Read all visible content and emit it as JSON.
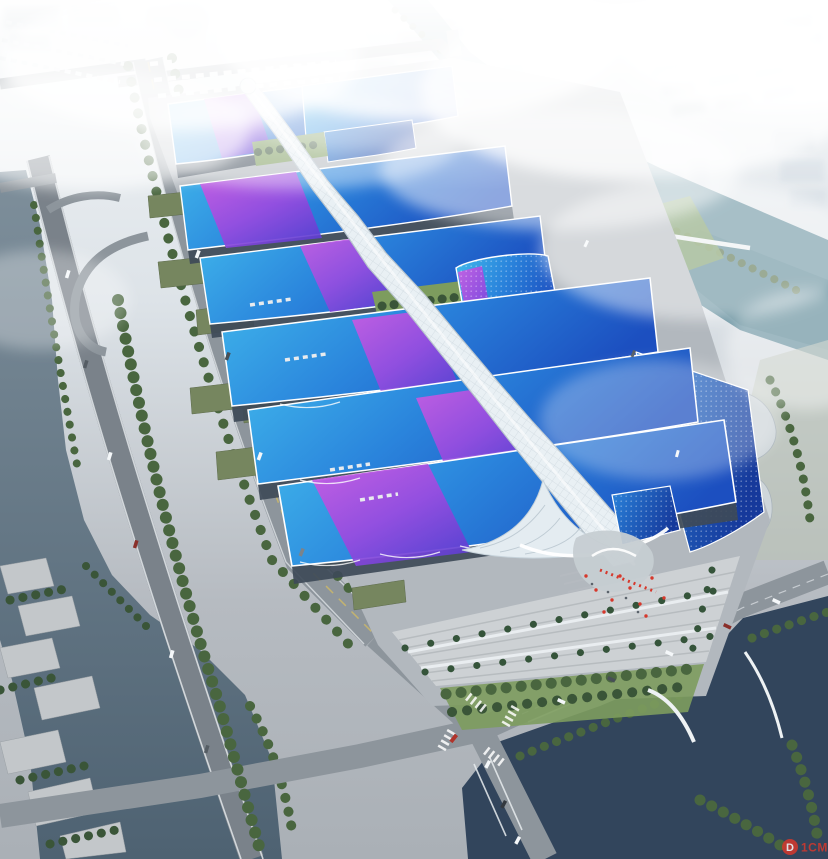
{
  "scene": {
    "type": "aerial-architectural-rendering",
    "subject": "large exhibition and convention center with wavy blue-and-purple roofs and a central white glass spine",
    "surroundings": [
      "foggy city skyline",
      "canals and rivers",
      "elevated expressway",
      "tree-lined boulevards",
      "entrance plaza with palm trees and red flags"
    ]
  },
  "watermark": {
    "badge_letter": "D",
    "text": "1CM",
    "color": "#d6382c"
  },
  "palette": {
    "fogTop": "#f2f5f7",
    "fogMid": "#dde3e8",
    "groundLight": "#c6cbd0",
    "ground": "#b6bbc1",
    "apron": "#b2b8be",
    "plaza": "#cdd1d4",
    "plazaLine": "#b2b7bb",
    "road": "#8d959c",
    "roadDark": "#7a828a",
    "roadEdge": "#e8ecef",
    "laneYellow": "#cdb968",
    "riverGray": "#7e8f9b",
    "riverGrayDeep": "#4e6272",
    "riverNavy": "#32455c",
    "canalTeal": "#5f8b9a",
    "lawn": "#7d9c5e",
    "tree": "#49663f",
    "treeDark": "#3a5538",
    "palm": "#35543a",
    "roofCyan": "#41b9ec",
    "roofMid": "#2a84dc",
    "roofDeep": "#1c4fc0",
    "roofDark": "#16399b",
    "purpleLight": "#d05ae2",
    "purple": "#9b4ae0",
    "violet": "#5f3fd2",
    "spine": "#e9f0f4",
    "spineEdge": "#b7c3cc",
    "facade": "#3e4a58",
    "waveWhite": "#e4ecf1",
    "cityBlock": "#ccd5dc",
    "cityTower": "#dbe2e8",
    "shed": "#76865f",
    "terrace": "#c3c7ca",
    "red": "#d6382c",
    "white": "#f4f7f9"
  }
}
